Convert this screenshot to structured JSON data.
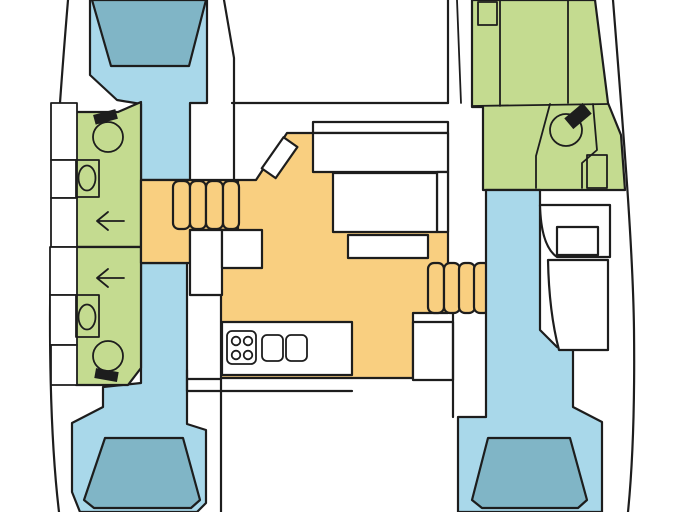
{
  "document": {
    "kind": "catamaran-interior-floorplan",
    "orientation": "bow-top",
    "visible_text": []
  },
  "colors": {
    "background": "#ffffff",
    "outline": "#1d1d1d",
    "cabin_blue": "#A9D8EA",
    "berth_blue": "#80B5C6",
    "bathroom_green": "#C4DB90",
    "saloon_orange": "#F9CF80",
    "furniture_white": "#ffffff",
    "fixture_black": "#1d1d1d"
  },
  "regions": {
    "port_hull": {
      "forward_cabin": "port-forward-cabin",
      "forward_berth": "port-forward-berth",
      "forward_bathroom": "port-forward-bathroom",
      "aft_bathroom": "port-aft-bathroom",
      "aft_cabin": "port-aft-cabin",
      "aft_berth": "port-aft-berth",
      "companionway_steps": "port-steps"
    },
    "saloon": {
      "main": "saloon",
      "nav_table": "nav-table",
      "front_bench": "front-bench",
      "table": "saloon-table",
      "aft_bench": "aft-bench",
      "galley_counter": "galley-counter",
      "stove": "stove-4-burner",
      "sinks": "double-sink"
    },
    "starboard_hull": {
      "forward_bathroom": "starboard-bathroom",
      "shower": "shower-stall",
      "toilet": "toilet",
      "desk": "vanity-desk",
      "aft_cabin": "starboard-aft-cabin",
      "aft_berth": "starboard-aft-berth",
      "companionway_steps": "starboard-steps"
    },
    "cockpit": "aft-cockpit"
  },
  "fixtures": [
    "toilet-icon",
    "sink-icon",
    "shower-arrow-icon",
    "stove-icon",
    "sink-basin-icon",
    "step-ladder-icon"
  ]
}
